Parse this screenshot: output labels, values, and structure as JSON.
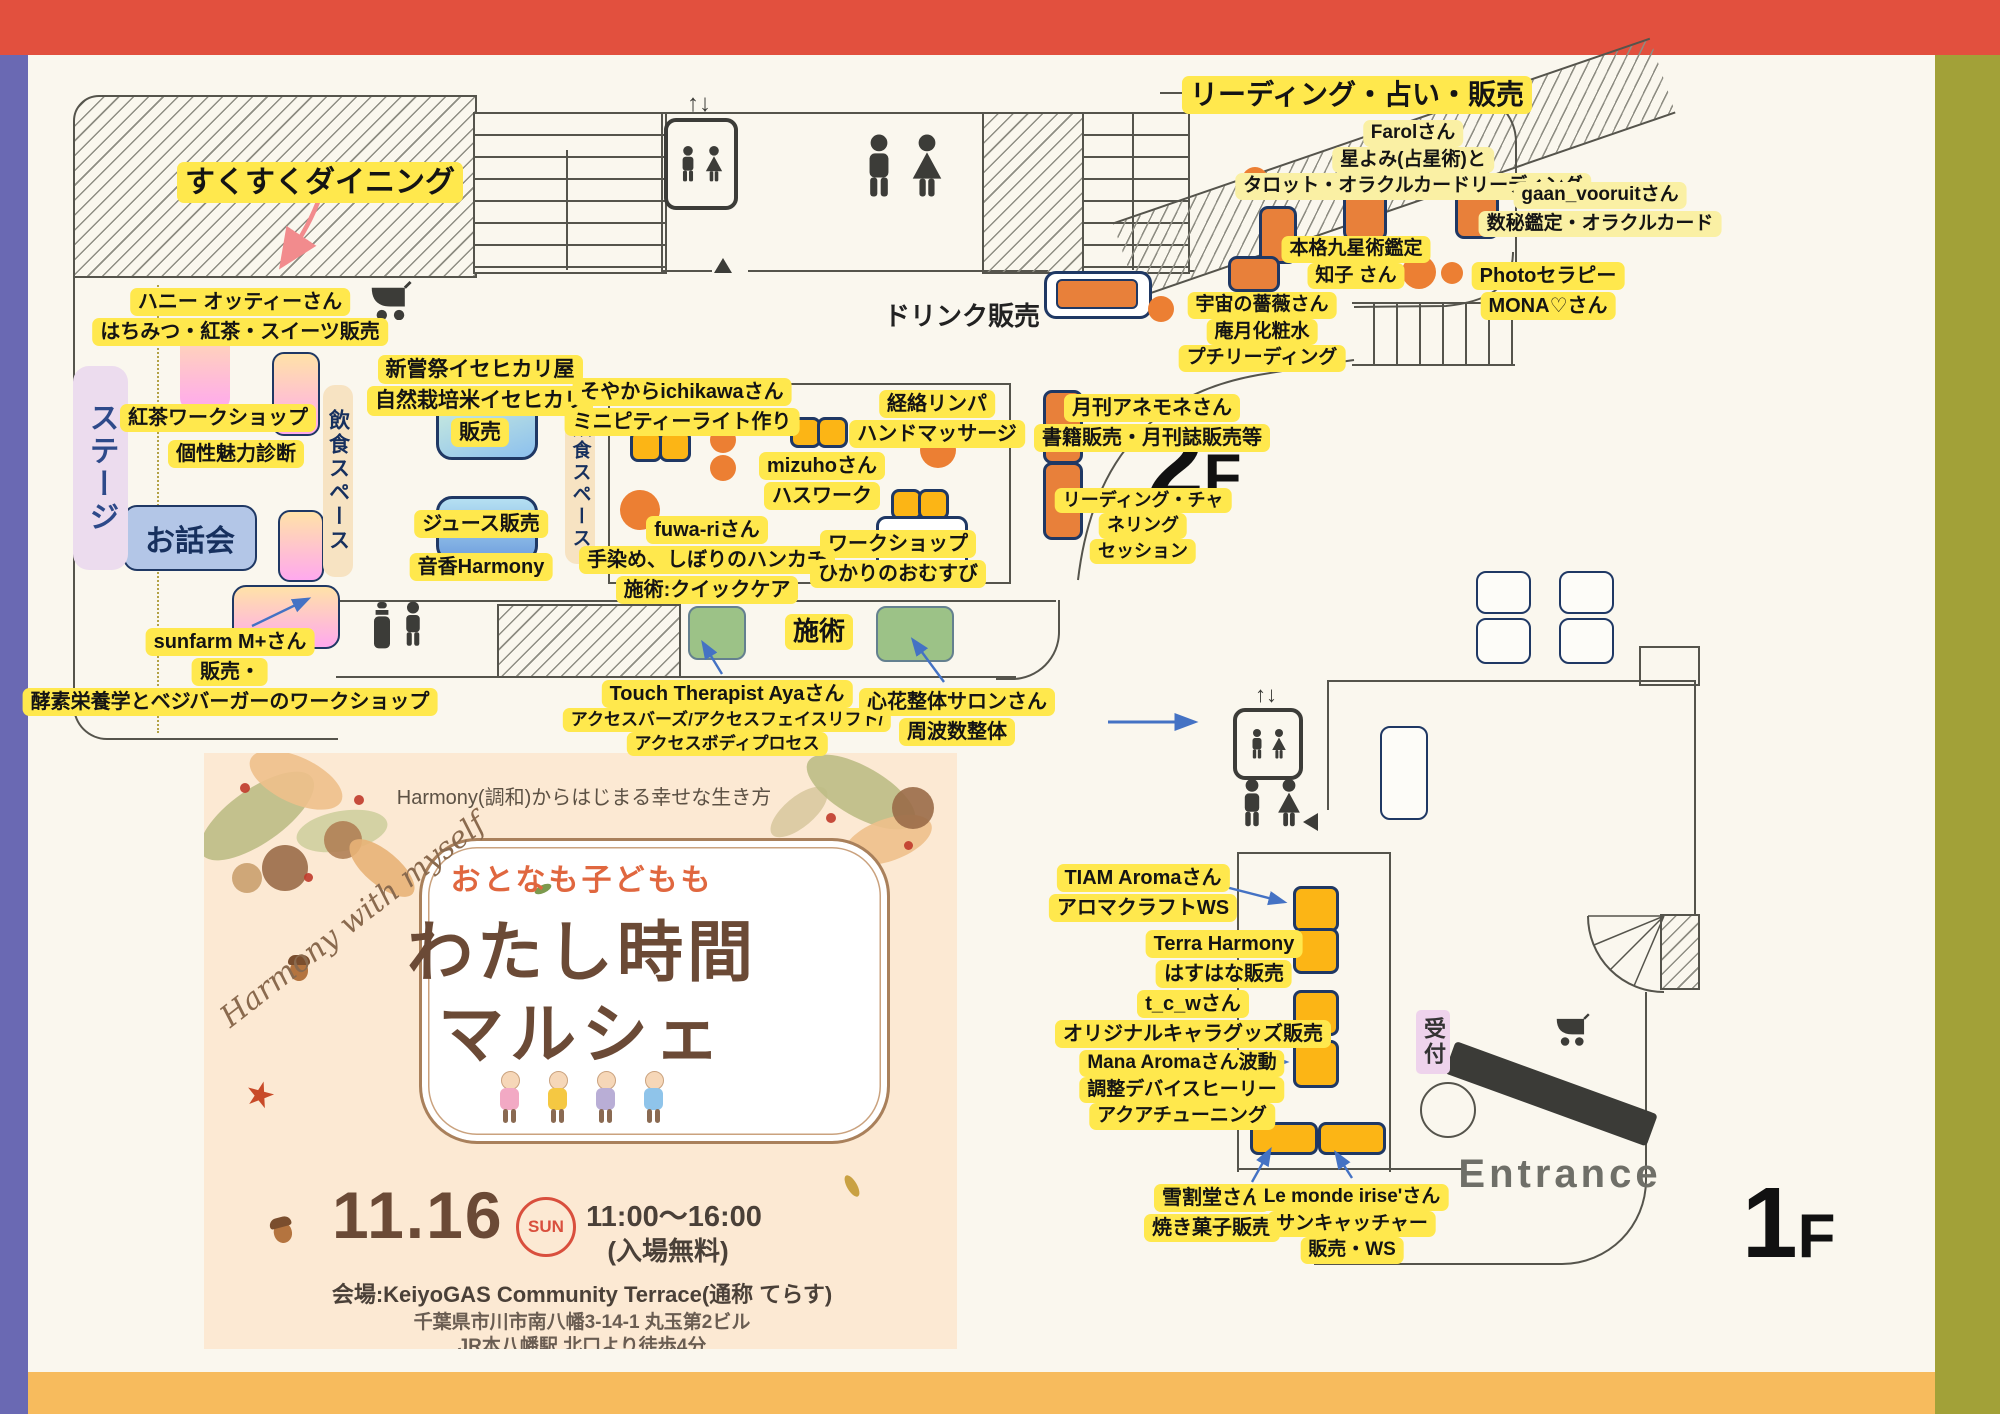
{
  "meta": {
    "floor2_label": "2F",
    "floor1_label": "1F"
  },
  "colors": {
    "top_bar": "#e2503e",
    "left_bar": "#6a69b3",
    "right_bar": "#a2a138",
    "bottom_bar": "#f7bb5d",
    "background": "#faf7ee",
    "highlight": "#ffe84d",
    "booth_orange": "#ec7f33",
    "booth_yellow": "#fcb515",
    "navy": "#1f3864",
    "green_box": "#9cc287"
  },
  "floor2": {
    "sukusuku": "すくすくダイニング",
    "honey": [
      "ハニー オッティーさん",
      "はちみつ・紅茶・スイーツ販売"
    ],
    "stage": "ステージ",
    "tea_workshop": "紅茶ワークショップ",
    "kosei": "個性魅力診断",
    "ohanashi": "お話会",
    "dining_space": "飲食スペース",
    "sunfarm": [
      "sunfarm M+さん",
      "販売・",
      "酵素栄養学とベジバーガーのワークショップ"
    ],
    "niiname": [
      "新嘗祭イセヒカリ屋",
      "自然栽培米イセヒカリ",
      "販売"
    ],
    "juice": "ジュース販売",
    "otoka": "音香Harmony",
    "soyakara": [
      "そやからichikawaさん",
      "ミニピティーライト作り"
    ],
    "mizuho": [
      "mizuhoさん",
      "ハスワーク"
    ],
    "keiraku": [
      "経絡リンパ",
      "ハンドマッサージ"
    ],
    "fuwari": [
      "fuwa-riさん",
      "手染め、しぼりのハンカチ",
      "施術:クイックケア"
    ],
    "hikari": [
      "ワークショップ",
      "ひかりのおむすび"
    ],
    "drink": "ドリンク販売",
    "reading_sale": "リーディング・占い・販売",
    "farol": [
      "Farolさん",
      "星よみ(占星術)と",
      "タロット・オラクルカードリーディング"
    ],
    "gaan": [
      "gaan_vooruitさん",
      "数秘鑑定・オラクルカード"
    ],
    "honkaku": [
      "本格九星術鑑定",
      "知子 さん"
    ],
    "photo": [
      "Photoセラピー",
      "MONA♡さん"
    ],
    "uchu": [
      "宇宙の薔薇さん",
      "庵月化粧水",
      "プチリーディング"
    ],
    "anemone": [
      "月刊アネモネさん",
      "書籍販売・月刊誌販売等"
    ],
    "session": [
      "リーディング・チャ",
      "ネリング",
      "セッション"
    ],
    "sejutsu": "施術",
    "touch": [
      "Touch Therapist Ayaさん",
      "アクセスバーズ/アクセスフェイスリフト/",
      "アクセスボディプロセス"
    ],
    "kokohana": [
      "心花整体サロンさん",
      "周波数整体"
    ]
  },
  "floor1": {
    "tiam": [
      "TIAM Aromaさん",
      "アロマクラフトWS"
    ],
    "terra": [
      "Terra Harmony",
      "はすはな販売"
    ],
    "tcw": [
      "t_c_wさん",
      "オリジナルキャラグッズ販売"
    ],
    "mana": [
      "Mana Aromaさん波動",
      "調整デバイスヒーリー",
      "アクアチューニング"
    ],
    "yukiwari": [
      "雪割堂さん",
      "焼き菓子販売"
    ],
    "lemonde": [
      "Le monde irise'さん",
      "サンキャッチャー",
      "販売・WS"
    ],
    "reception": "受付",
    "entrance": "Entrance"
  },
  "poster": {
    "tagline": "Harmony(調和)からはじまる幸せな生き方",
    "script": "Harmony with myself",
    "subtitle": "おとなも子どもも",
    "title1": "わたし時間",
    "title2": "マルシェ",
    "date": "11.16",
    "day": "SUN",
    "time": "11:00〜16:00",
    "free": "(入場無料)",
    "venue": "会場:KeiyoGAS Community Terrace(通称 てらす)",
    "address": "千葉県市川市南八幡3-14-1 丸玉第2ビル",
    "access": "JR本八幡駅 北口より徒歩4分"
  },
  "icons": [
    "elevator-icon",
    "restroom-icon",
    "stroller-icon",
    "baby-care-icon",
    "up-arrow-icon",
    "left-arrow-icon"
  ]
}
